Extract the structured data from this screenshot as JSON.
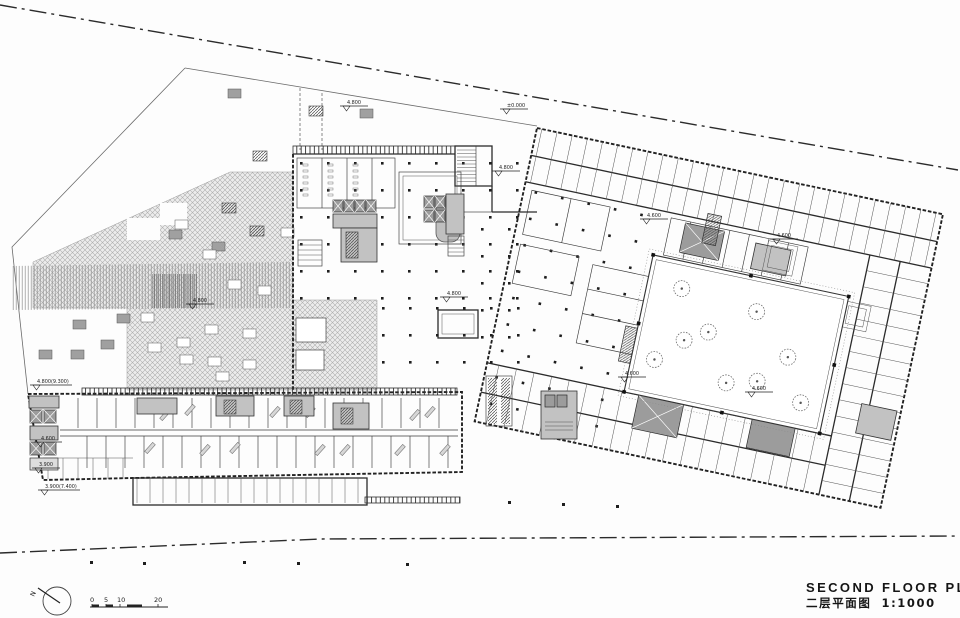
{
  "drawing": {
    "type": "architectural-floor-plan",
    "title_en": "SECOND FLOOR PLAN",
    "title_zh": "二层平面图",
    "scale_label": "1:1000",
    "north_label": "N",
    "scale_bar_labels": [
      "0",
      "5",
      "10",
      "20"
    ],
    "elevation_labels": [
      {
        "text": "4.800",
        "x": 340,
        "y": 104
      },
      {
        "text": "±0.000",
        "x": 500,
        "y": 107
      },
      {
        "text": "4.800",
        "x": 492,
        "y": 169
      },
      {
        "text": "4.600",
        "x": 640,
        "y": 217
      },
      {
        "text": "4.600",
        "x": 770,
        "y": 237
      },
      {
        "text": "4.800",
        "x": 440,
        "y": 295
      },
      {
        "text": "4.800",
        "x": 186,
        "y": 302
      },
      {
        "text": "4.800(9.300)",
        "x": 30,
        "y": 383
      },
      {
        "text": "4.600",
        "x": 34,
        "y": 440
      },
      {
        "text": "3.900",
        "x": 32,
        "y": 466
      },
      {
        "text": "3.900(7.400)",
        "x": 38,
        "y": 488
      },
      {
        "text": "4.600",
        "x": 618,
        "y": 375
      },
      {
        "text": "4.600",
        "x": 745,
        "y": 390
      }
    ]
  },
  "colors": {
    "paper": "#fdfdfd",
    "line": "#2b2b2b",
    "plaza_hatch": "#b0b0b0",
    "core_fill": "#c2c2c2",
    "core_dark": "#9c9c9c"
  }
}
